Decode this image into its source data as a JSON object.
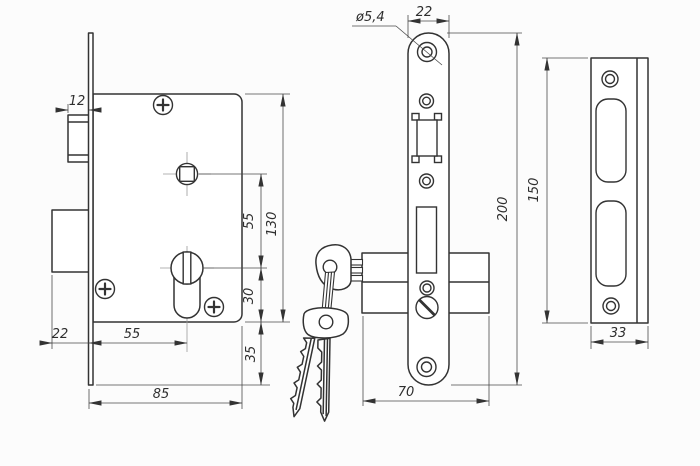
{
  "colors": {
    "background": "#fcfcfc",
    "line": "#333333"
  },
  "views": {
    "side": {
      "label": "lock case side view",
      "dims": {
        "latch_throw": "12",
        "spindle_to_cylinder": "55",
        "case_height": "130",
        "cylinder_to_case_bottom": "30",
        "case_bottom_to_plate": "35",
        "deadbolt_throw": "22",
        "backset": "55",
        "case_depth": "85"
      }
    },
    "front": {
      "label": "faceplate front view with keys",
      "dims": {
        "hole_diameter": "ø5,4",
        "plate_width": "22",
        "plate_height": "200",
        "case_length": "70"
      }
    },
    "strike": {
      "label": "strike plate front view",
      "dims": {
        "plate_height": "150",
        "plate_width": "33"
      }
    }
  }
}
